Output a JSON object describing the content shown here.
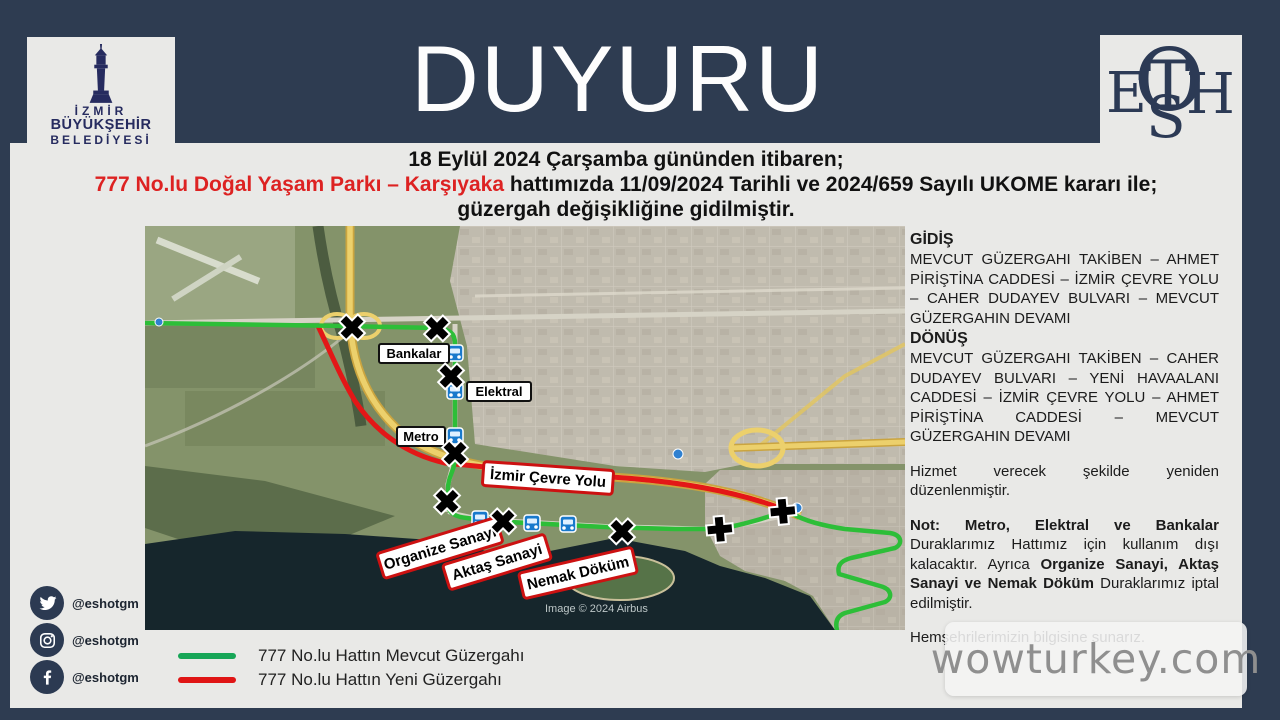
{
  "page": {
    "title": "DUYURU",
    "band_color": "#2e3c51",
    "content_color": "#e9e9e7"
  },
  "logos": {
    "izmir": {
      "line1": "İZMİR",
      "line2": "BÜYÜKŞEHİR",
      "line3": "BELEDİYESİ"
    },
    "eshot_letters": [
      "E",
      "S",
      "T",
      "H",
      "O"
    ]
  },
  "announcement": {
    "line1": "18 Eylül 2024 Çarşamba gününden itibaren;",
    "line2_red": "777 No.lu Doğal Yaşam Parkı – Karşıyaka",
    "line2_black": " hattımızda 11/09/2024 Tarihli ve 2024/659 Sayılı UKOME kararı ile;",
    "line3": "güzergah değişikliğine gidilmiştir."
  },
  "route_info": {
    "gidis_title": "GİDİŞ",
    "gidis_text": "MEVCUT GÜZERGAHI TAKİBEN – AHMET PİRİŞTİNA CADDESİ – İZMİR ÇEVRE YOLU – CAHER DUDAYEV BULVARI – MEVCUT GÜZERGAHIN DEVAMI",
    "donus_title": "DÖNÜŞ",
    "donus_text": "MEVCUT GÜZERGAHI TAKİBEN – CAHER DUDAYEV BULVARI – YENİ HAVAALANI CADDESİ – İZMİR ÇEVRE YOLU – AHMET PİRİŞTİNA CADDESİ – MEVCUT GÜZERGAHIN DEVAMI",
    "service_note": "Hizmet verecek şekilde yeniden düzenlenmiştir.",
    "note_bold1": "Not: Metro, Elektral ve Bankalar",
    "note_text1": " Duraklarımız Hattımız için kullanım dışı kalacaktır. Ayrıca ",
    "note_bold2": "Organize Sanayi, Aktaş Sanayi ve Nemak Döküm",
    "note_text2": " Duraklarımız iptal edilmiştir.",
    "closing": "Hemşehrilerimizin bilgisine sunarız."
  },
  "map": {
    "stops": [
      {
        "label": "Bankalar"
      },
      {
        "label": "Elektral"
      },
      {
        "label": "Metro"
      }
    ],
    "highway_label": "İzmir Çevre Yolu",
    "cancelled_stops": [
      {
        "label": "Organize Sanayi"
      },
      {
        "label": "Aktaş Sanayi"
      },
      {
        "label": "Nemak Döküm"
      }
    ],
    "copyright": "Image © 2024 Airbus",
    "route_colors": {
      "current": "#2dbe38",
      "new": "#e31717"
    }
  },
  "legend": {
    "items": [
      {
        "label": "777  No.lu Hattın Mevcut Güzergahı",
        "color": "#17a657"
      },
      {
        "label": "777  No.lu Hattın Yeni Güzergahı",
        "color": "#e01515"
      }
    ]
  },
  "social": {
    "handle": "@eshotgm",
    "platforms": [
      "twitter",
      "instagram",
      "facebook"
    ]
  },
  "watermark": "wowturkey.com"
}
